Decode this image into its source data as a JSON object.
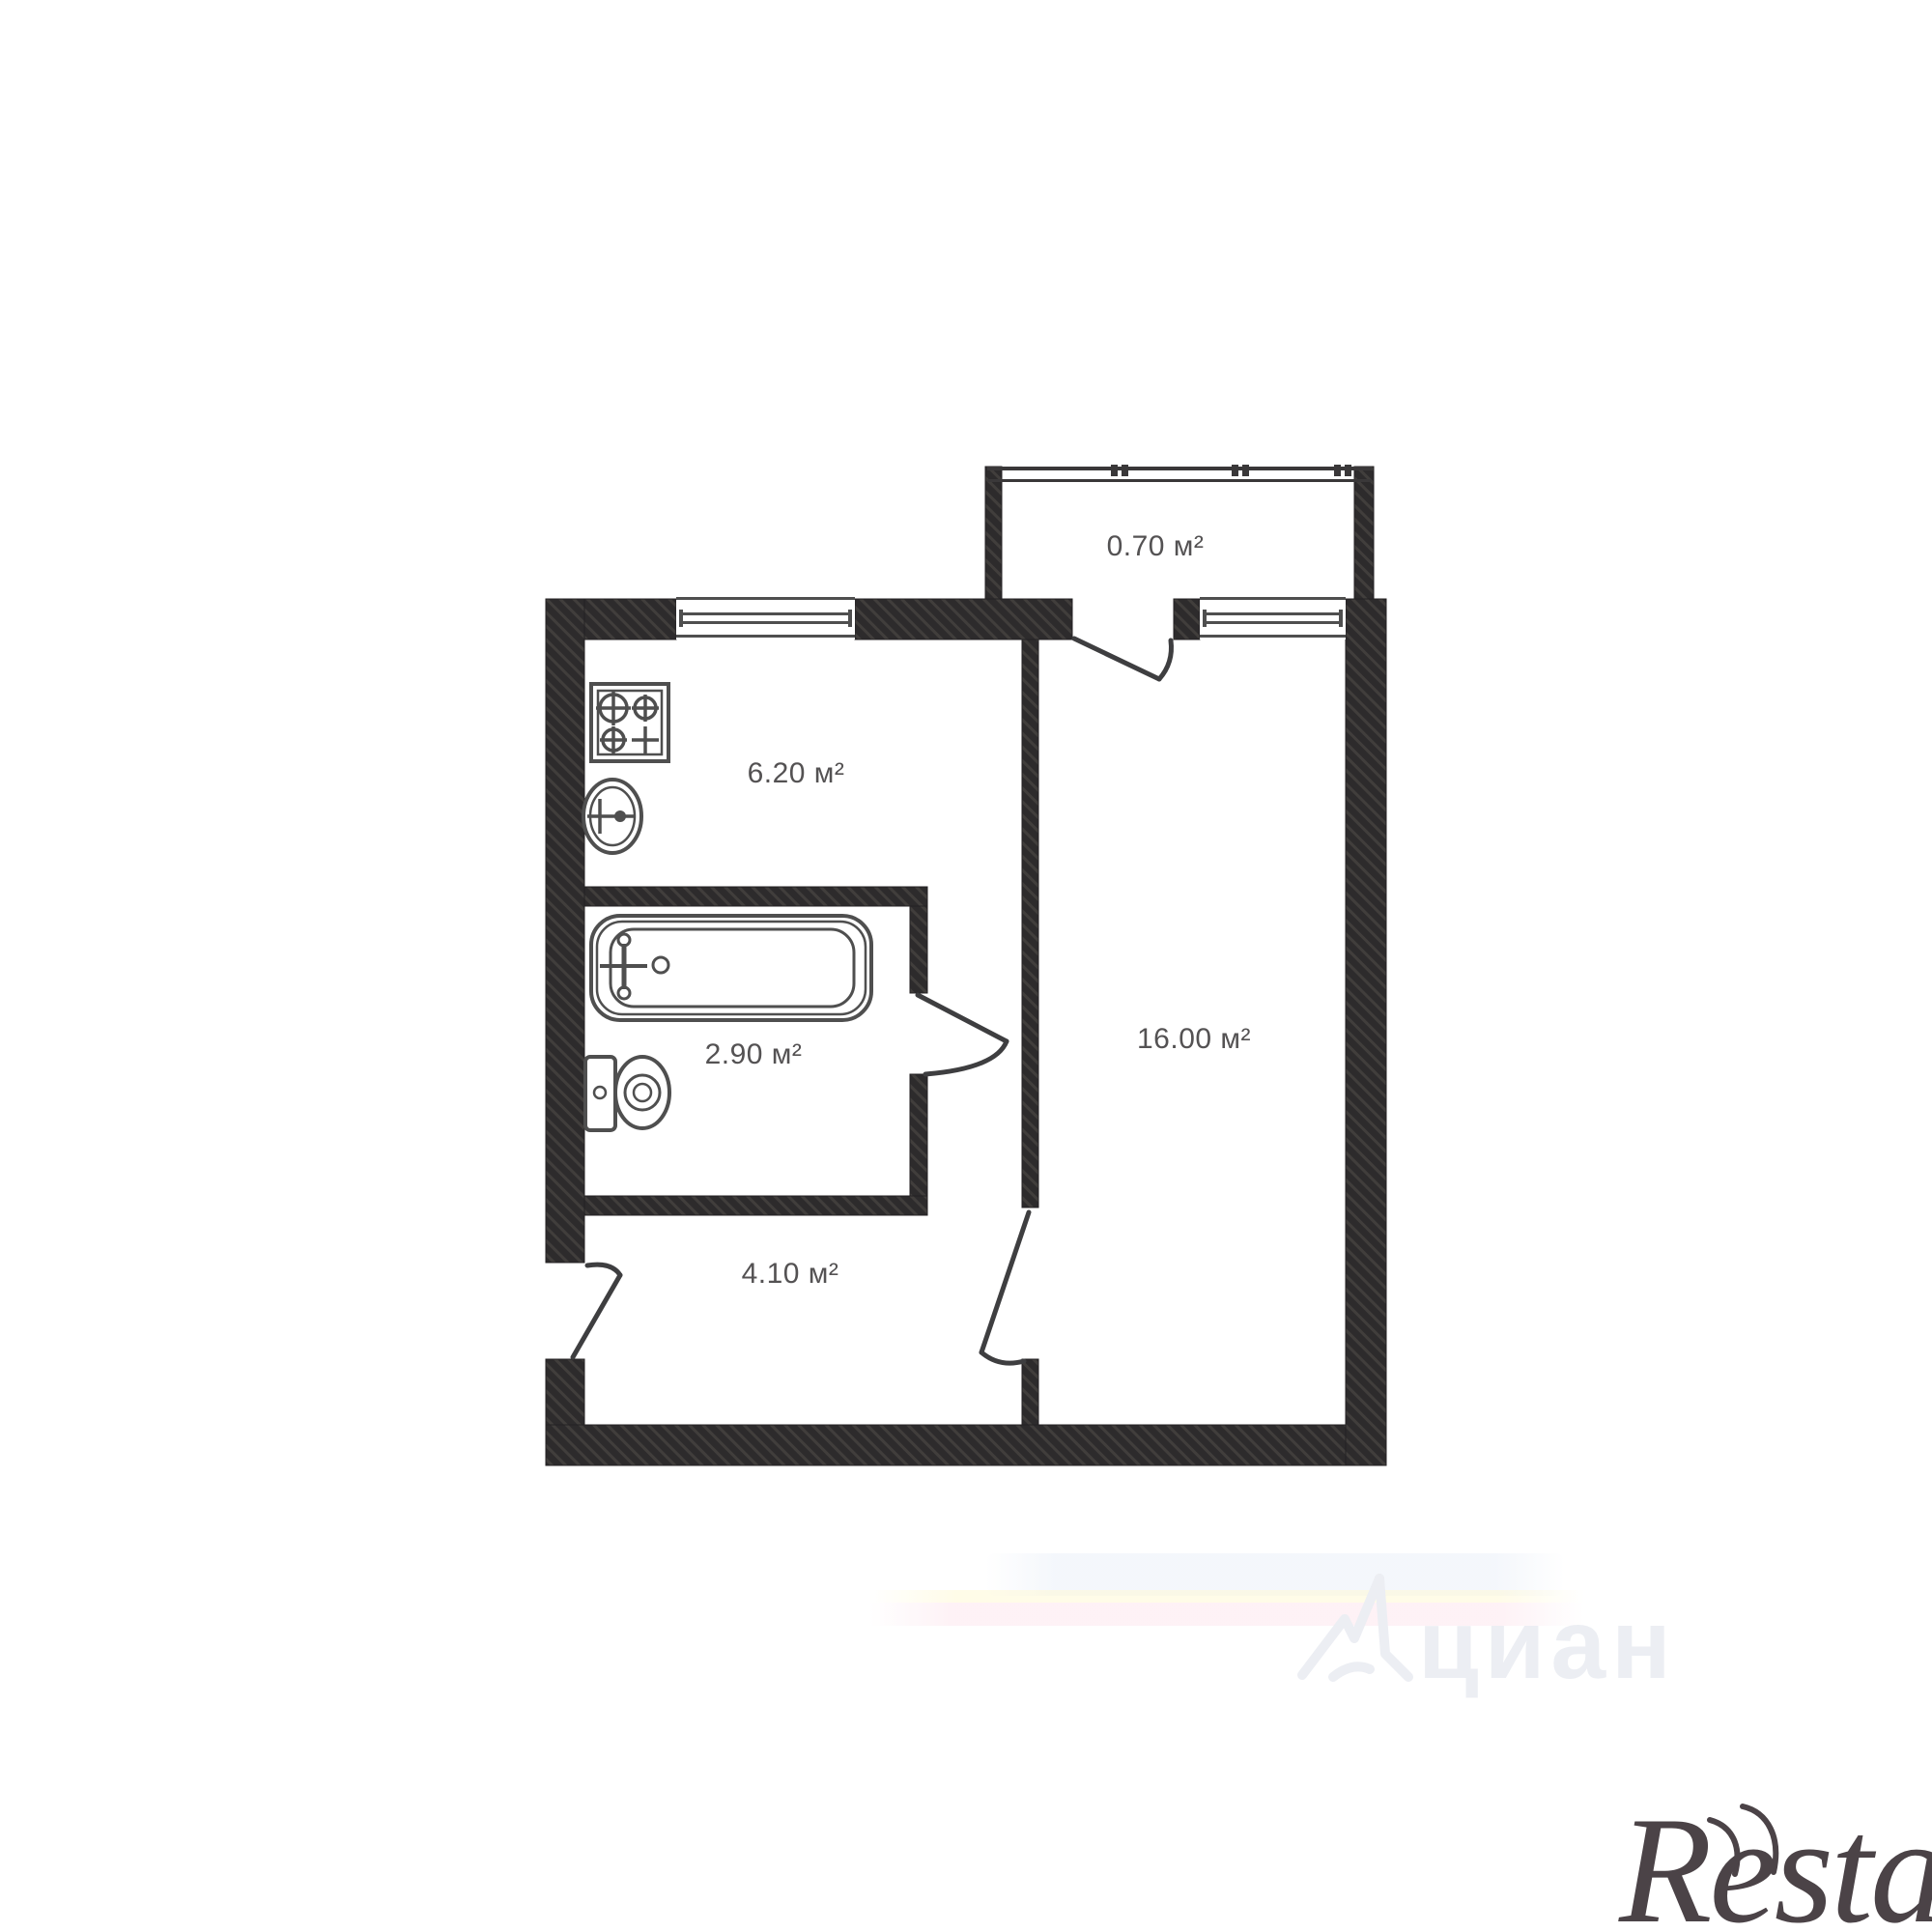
{
  "plan_title": "apartment-floor-plan",
  "rooms": [
    {
      "name": "balcony",
      "label": "0.70 м²"
    },
    {
      "name": "kitchen",
      "label": "6.20 м²"
    },
    {
      "name": "bathroom",
      "label": "2.90 м²"
    },
    {
      "name": "living-room",
      "label": "16.00 м²"
    },
    {
      "name": "hallway",
      "label": "4.10 м²"
    }
  ],
  "watermarks": {
    "brand": "Restate",
    "portal": "циан"
  },
  "icons": {
    "stove-icon": "four-burner gas stove symbol",
    "sink-icon": "round kitchen sink with tap cross",
    "bathtub-icon": "bathtub with tap cross",
    "toilet-icon": "toilet with cistern"
  },
  "colors": {
    "wall_fill": "#2d2b2c",
    "wall_hatch": "#413e3c",
    "fixture_line": "#4f4f4f",
    "door_line": "#3e3e40",
    "label_text": "#545253",
    "background": "#ffffff",
    "brand_text": "#4b4347",
    "portal_text": "#eceef3"
  }
}
